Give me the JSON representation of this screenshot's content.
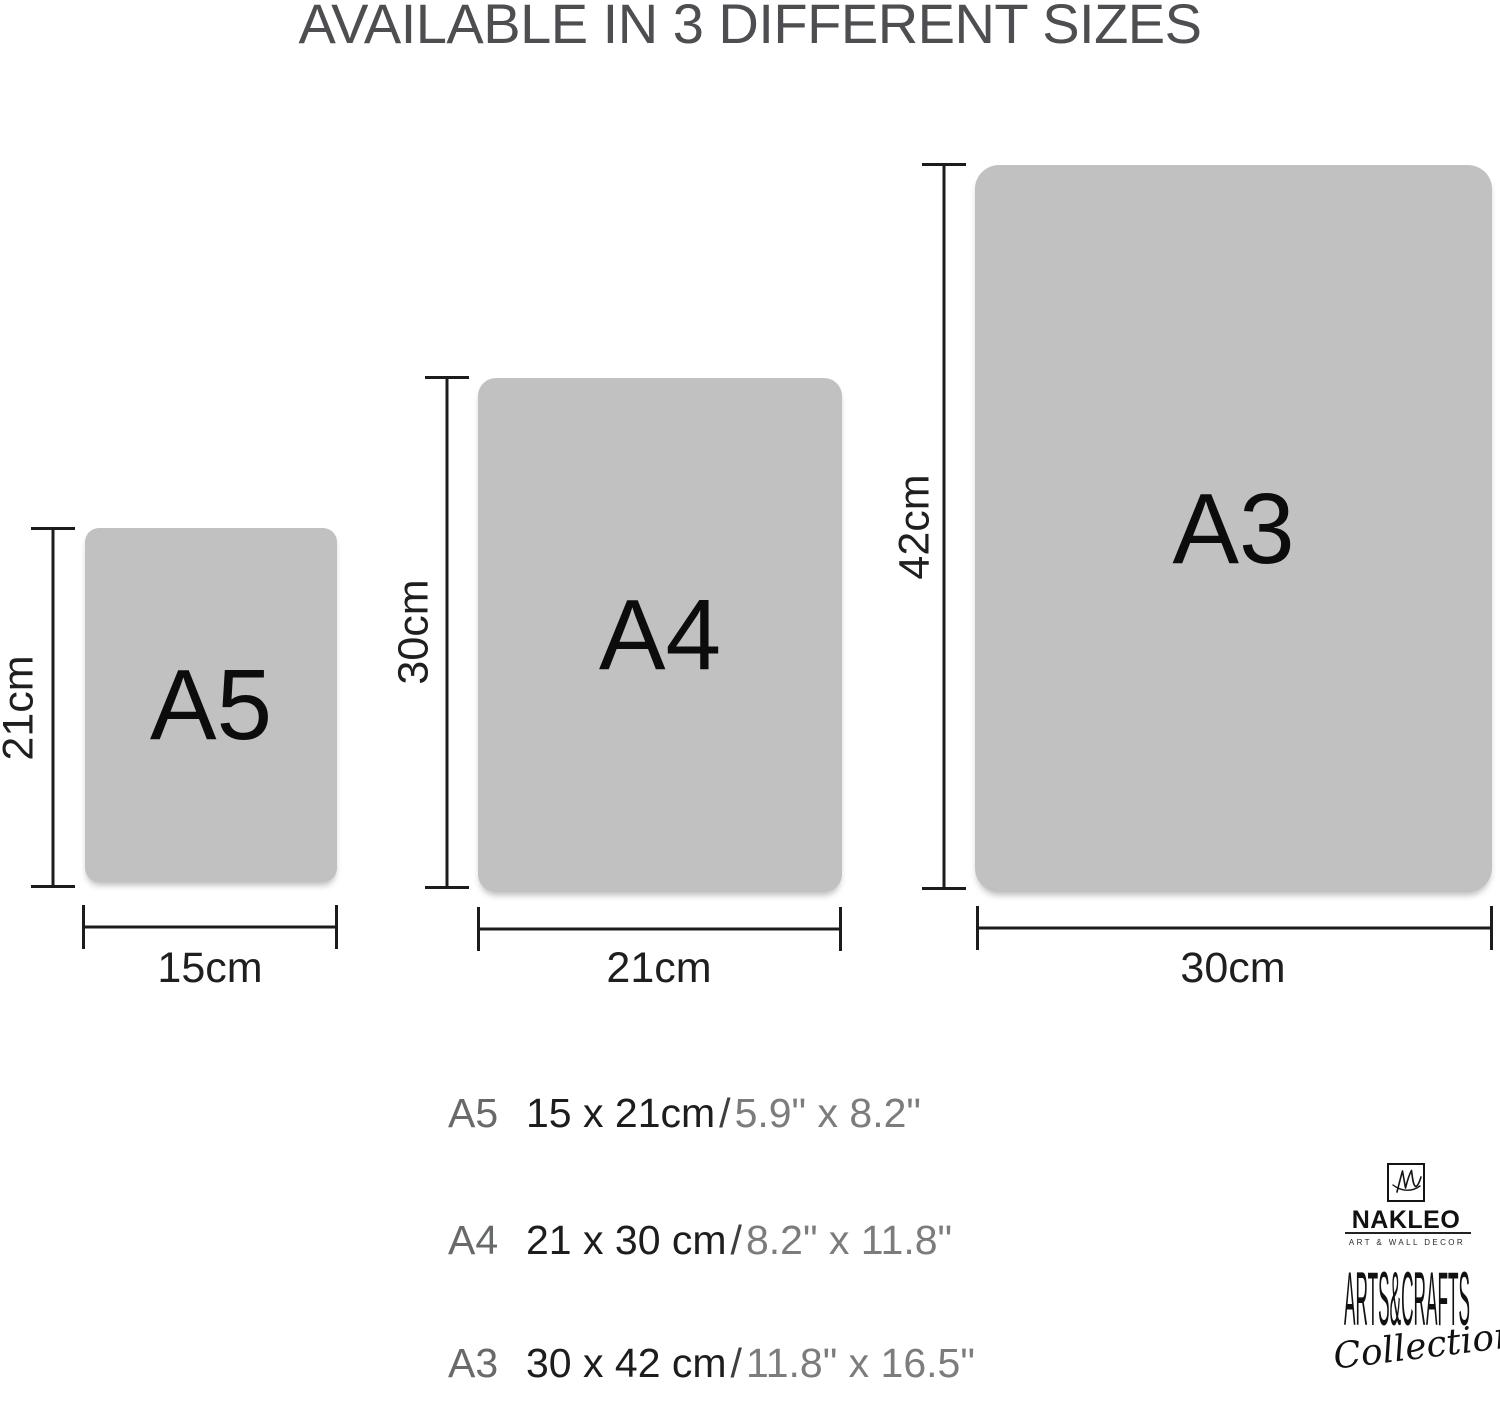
{
  "title": "AVAILABLE IN 3 DIFFERENT SIZES",
  "sizes": [
    {
      "name": "A5",
      "height": "21cm",
      "width": "15cm"
    },
    {
      "name": "A4",
      "height": "30cm",
      "width": "21cm"
    },
    {
      "name": "A3",
      "height": "42cm",
      "width": "30cm"
    }
  ],
  "specs": [
    {
      "name": "A5",
      "metric": "15 x 21cm",
      "separator": "/",
      "imperial": "5.9\" x 8.2\""
    },
    {
      "name": "A4",
      "metric": "21 x 30 cm",
      "separator": "/",
      "imperial": "8.2\" x 11.8\""
    },
    {
      "name": "A3",
      "metric": "30 x 42 cm",
      "separator": "/",
      "imperial": "11.8\" x 16.5\""
    }
  ],
  "brand": {
    "monogram_icon": "nl-signature-icon",
    "name": "NAKLEO",
    "tagline": "ART & WALL DECOR",
    "collection_top": "ARTS&CRAFTS",
    "collection_bottom": "Collection"
  },
  "colors": {
    "background": "#ffffff",
    "paper_fill": "#c2c1c1",
    "paper_label": "#0c0c0c",
    "measure_line": "#1c1c1c",
    "title_text": "#4d4e51",
    "spec_label": "#68696b",
    "spec_metric": "#1d1d1d",
    "spec_imperial": "#7b7c7e",
    "brand_ink": "#111111"
  }
}
